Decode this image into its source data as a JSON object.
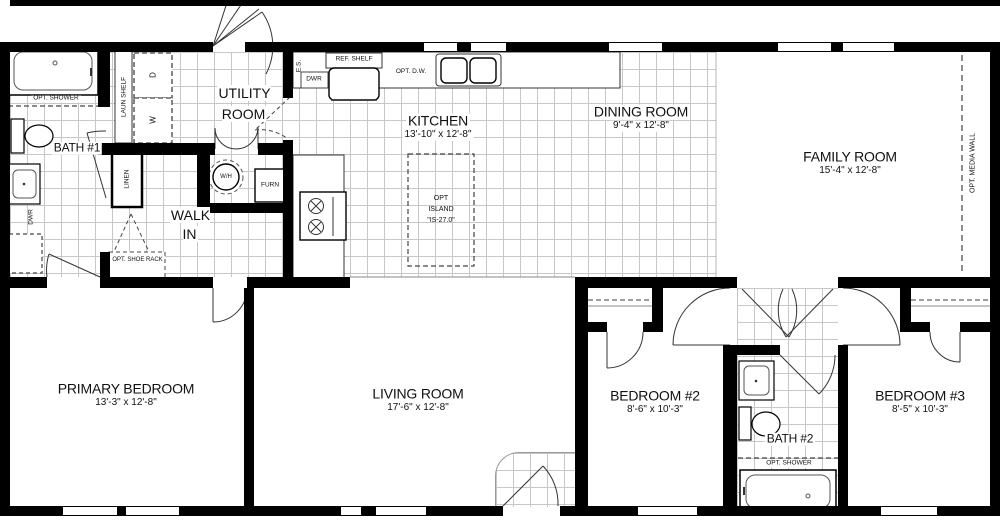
{
  "plan": {
    "rooms": {
      "bath1": {
        "name": "BATH #1"
      },
      "utility": {
        "name": "UTILITY ROOM"
      },
      "kitchen": {
        "name": "KITCHEN",
        "dims": "13'-10\" x 12'-8\""
      },
      "dining": {
        "name": "DINING ROOM",
        "dims": "9'-4\" x 12'-8\""
      },
      "family": {
        "name": "FAMILY ROOM",
        "dims": "15'-4\" x 12'-8\""
      },
      "walkin": {
        "name": "WALK IN"
      },
      "primary": {
        "name": "PRIMARY BEDROOM",
        "dims": "13'-3\" x 12'-8\""
      },
      "living": {
        "name": "LIVING ROOM",
        "dims": "17'-6\" x 12'-8\""
      },
      "bedroom2": {
        "name": "BEDROOM #2",
        "dims": "8'-6\" x 10'-3\""
      },
      "bath2": {
        "name": "BATH #2"
      },
      "bedroom3": {
        "name": "BEDROOM #3",
        "dims": "8'-5\" x 10'-3\""
      }
    },
    "fixtures": {
      "opt_shower1": "OPT. SHOWER",
      "opt_shower2": "OPT. SHOWER",
      "dwr_bath1": "DWR",
      "laun_shelf": "LAUN SHELF",
      "dryer": "D",
      "washer": "W",
      "es": "E.S.",
      "dwr_kitchen": "DWR",
      "ref_shelf": "REF. SHELF",
      "opt_dw": "OPT. D.W.",
      "water_heater": "W/H",
      "furnace": "FURN",
      "linen": "LINEN",
      "shoe_rack": "OPT. SHOE RACK",
      "island_l1": "OPT",
      "island_l2": "ISLAND",
      "island_l3": "\"IS-27.0\"",
      "media_wall": "OPT. MEDIA WALL"
    }
  }
}
